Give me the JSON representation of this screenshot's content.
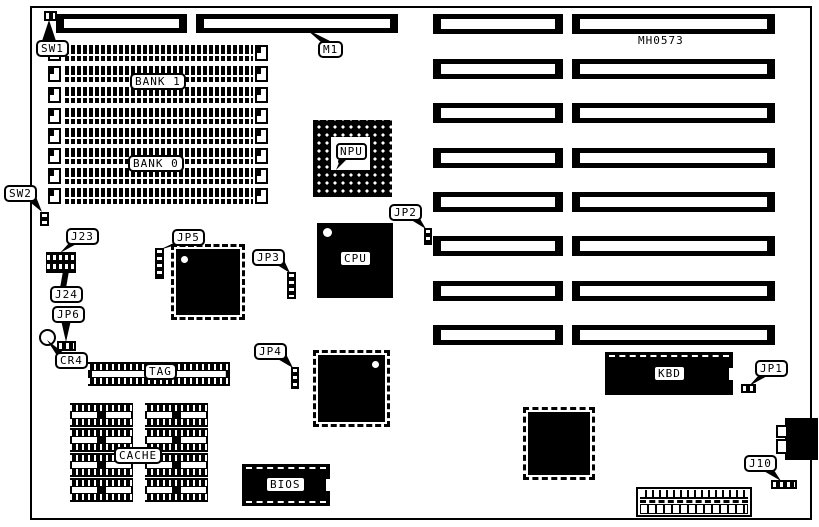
{
  "board": {
    "id_label": "MH0573",
    "labels": {
      "sw1": "SW1",
      "sw2": "SW2",
      "m1": "M1",
      "bank1": "BANK 1",
      "bank0": "BANK 0",
      "j23": "J23",
      "j24": "J24",
      "jp6": "JP6",
      "cr4": "CR4",
      "jp5": "JP5",
      "jp3": "JP3",
      "jp2": "JP2",
      "jp4": "JP4",
      "tag": "TAG",
      "cache": "CACHE",
      "bios": "BIOS",
      "cpu": "CPU",
      "npu": "NPU",
      "kbd": "KBD",
      "jp1": "JP1",
      "j10": "J10"
    },
    "colors": {
      "ink": "#000000",
      "paper": "#ffffff"
    }
  }
}
